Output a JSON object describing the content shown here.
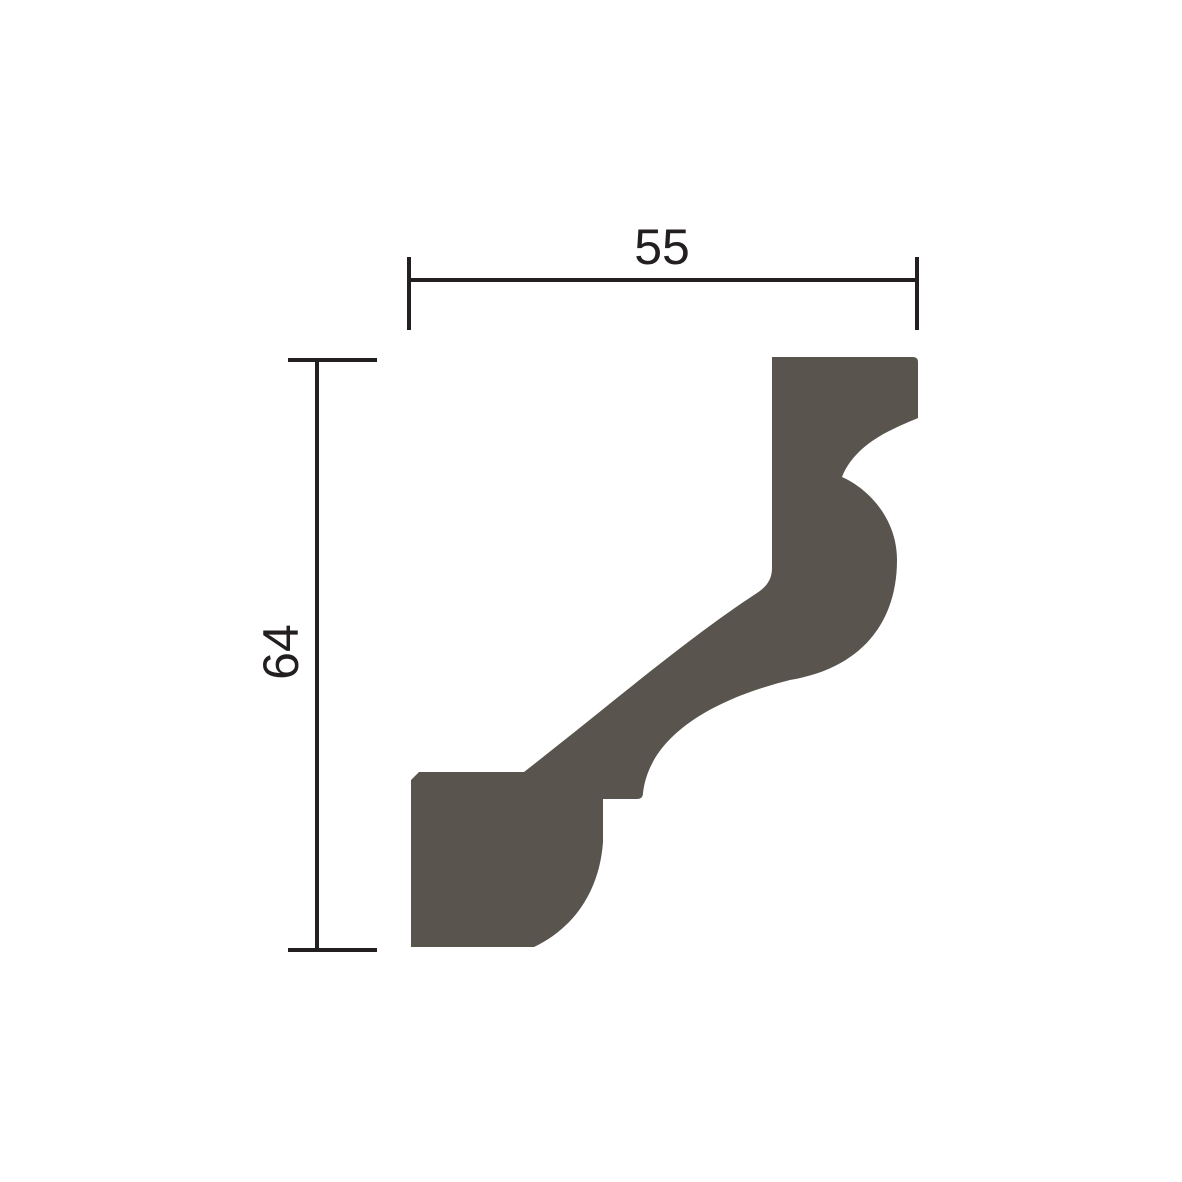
{
  "diagram": {
    "subject": "crown-molding-profile-cross-section",
    "width_dimension": {
      "label": "55"
    },
    "height_dimension": {
      "label": "64"
    }
  },
  "colors": {
    "profile_fill": "#59544e",
    "dimension": "#231f20",
    "background": "#ffffff"
  }
}
